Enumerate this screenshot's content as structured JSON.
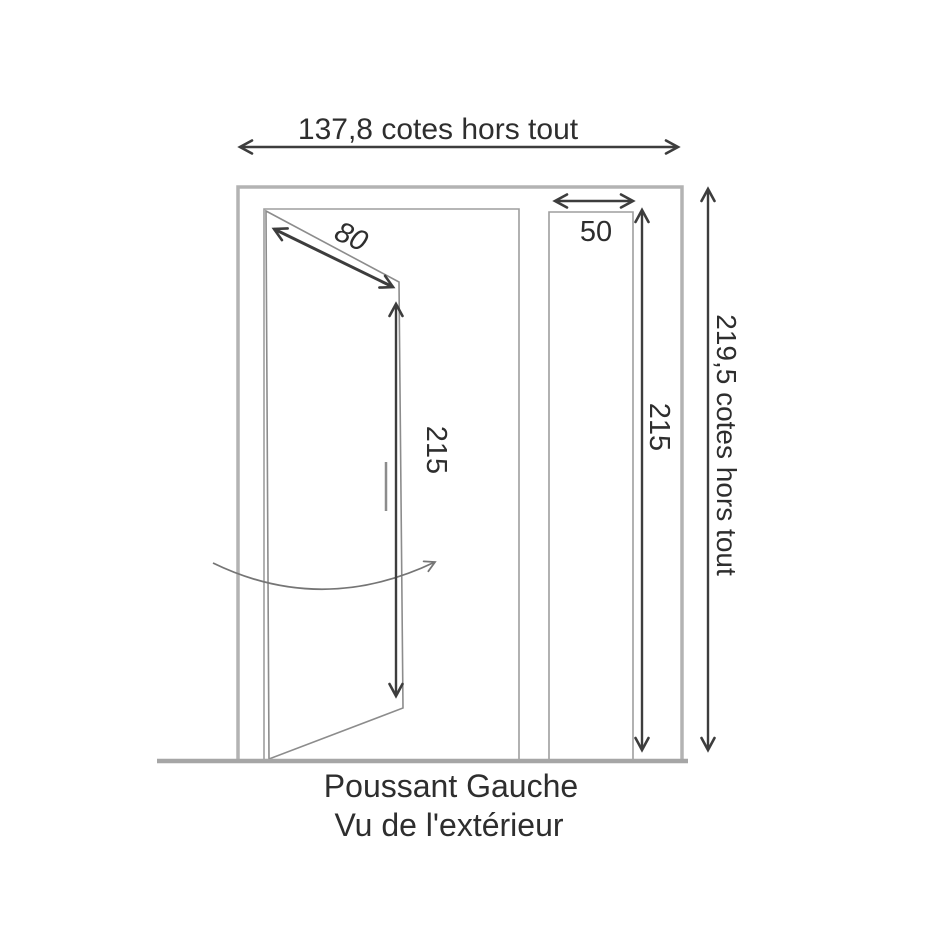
{
  "diagram": {
    "type": "door-technical-drawing",
    "dimensions": {
      "overall_width": "137,8 cotes hors tout",
      "leaf_diagonal": "80",
      "leaf_height": "215",
      "panel_width": "50",
      "panel_height": "215",
      "overall_height": "219,5 cotes hors tout"
    },
    "caption": {
      "line1": "Poussant Gauche",
      "line2": "Vu de l'extérieur"
    }
  },
  "colors": {
    "text-color": "#2e2e2e",
    "dimension-line": "#3d3d3d",
    "frame-outer": "#b3b3b3",
    "frame-inner": "#9e9e9e",
    "door-line": "#8c8c8c",
    "arc-line": "#757575",
    "floor-line": "#a6a6a6",
    "background": "#ffffff"
  }
}
